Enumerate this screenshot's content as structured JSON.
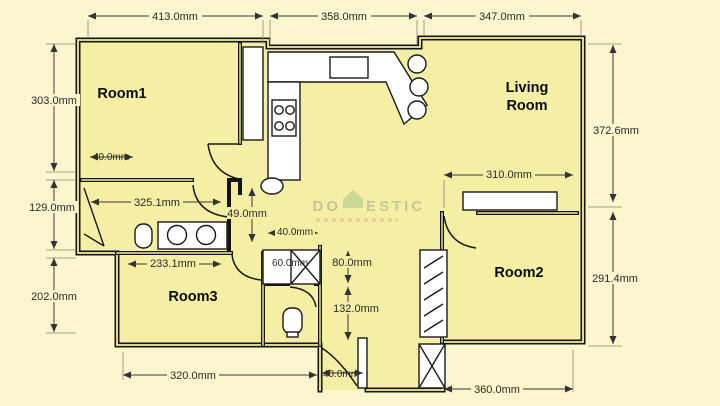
{
  "colors": {
    "background": "#FBF6CD",
    "floor": "#F5EFA5",
    "wall": "#141414",
    "dimension_text": "#2A2A2A",
    "fixture": "#FFFFFF",
    "watermark_green": "#A9B386"
  },
  "rooms": {
    "room1": "Room1",
    "living_line1": "Living",
    "living_line2": "Room",
    "room2": "Room2",
    "room3": "Room3"
  },
  "dims": {
    "top_left": "413.0mm",
    "top_mid": "358.0mm",
    "top_right": "347.0mm",
    "left_upper": "303.0mm",
    "left_mid": "129.0mm",
    "left_lower": "202.0mm",
    "right_upper": "372.6mm",
    "right_lower": "291.4mm",
    "room1_door": "40.0mm",
    "bath_width": "325.1mm",
    "hall_height": "49.0mm",
    "room3_top": "233.1mm",
    "closet_top": "40.0mm",
    "closet_left": "60.0mm",
    "closet_height": "80.0mm",
    "wc_height": "132.0mm",
    "shelf_width": "310.0mm",
    "room3_bottom": "320.0mm",
    "entry_width": "40.0mm",
    "bottom_right": "360.0mm"
  },
  "watermark": {
    "prefix": "DO",
    "suffix": "ESTIC"
  }
}
